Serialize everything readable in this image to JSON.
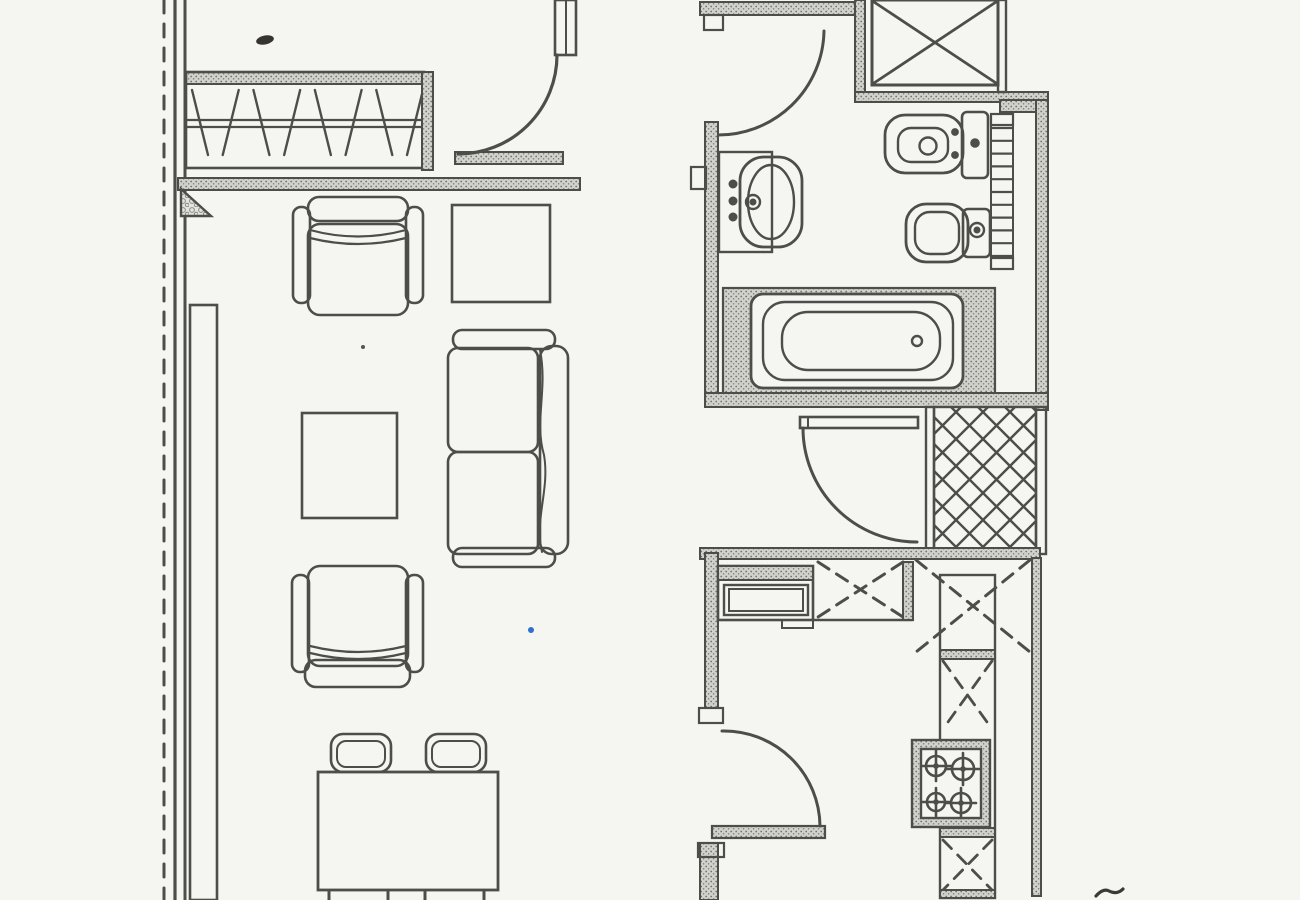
{
  "document": {
    "kind": "scanned-floor-plan",
    "title": "apartment-floor-plan"
  },
  "canvas": {
    "w": 1300,
    "h": 900,
    "paper": "#f5f5f2",
    "ink": "#4d4d49",
    "accent_blue": "#2f6fce"
  },
  "elements": [
    {
      "name": "site-boundary-dashed-line",
      "kind": "line",
      "x1": 164,
      "y1": 0,
      "x2": 164,
      "y2": 900,
      "dash": "13 11",
      "sw": 3
    },
    {
      "name": "left-wall-outer-line",
      "kind": "line",
      "x1": 175,
      "y1": 0,
      "x2": 175,
      "y2": 900,
      "sw": 3.2
    },
    {
      "name": "left-wall-inner-line",
      "kind": "line",
      "x1": 185,
      "y1": 0,
      "x2": 185,
      "y2": 900,
      "sw": 3
    },
    {
      "name": "wardrobe-top-wall",
      "kind": "rect",
      "x": 185,
      "y": 72,
      "w": 240,
      "h": 12,
      "fill": "stipple",
      "sw": 2
    },
    {
      "name": "wardrobe-outline",
      "kind": "rect",
      "x": 186,
      "y": 72,
      "w": 238,
      "h": 96,
      "sw": 2.6
    },
    {
      "name": "wardrobe-rail-upper",
      "kind": "line",
      "x1": 187,
      "y1": 120,
      "x2": 423,
      "y2": 120,
      "sw": 2.2
    },
    {
      "name": "wardrobe-rail-lower",
      "kind": "line",
      "x1": 187,
      "y1": 127,
      "x2": 423,
      "y2": 127,
      "sw": 2.2
    },
    {
      "name": "wardrobe-hangers",
      "kind": "zigzag",
      "x": 192,
      "y": 90,
      "w": 215,
      "h": 65,
      "n": 8,
      "slant": 16,
      "sw": 2.4
    },
    {
      "name": "wardrobe-partition-wall",
      "kind": "rect",
      "x": 422,
      "y": 72,
      "w": 11,
      "h": 98,
      "fill": "stipple",
      "sw": 2
    },
    {
      "name": "entry-threshold-wall",
      "kind": "rect",
      "x": 455,
      "y": 152,
      "w": 108,
      "h": 12,
      "fill": "stipple",
      "sw": 2
    },
    {
      "name": "living-divider-wall",
      "kind": "rect",
      "x": 178,
      "y": 178,
      "w": 402,
      "h": 12,
      "fill": "stipple",
      "sw": 2
    },
    {
      "name": "corner-buttress-triangle",
      "kind": "poly",
      "points": "181,189 181,216 211,216",
      "fill": "pebble",
      "sw": 2.4
    },
    {
      "name": "entry-door-jamb",
      "kind": "rect",
      "x": 555,
      "y": 0,
      "w": 21,
      "h": 55,
      "fill": "paper",
      "sw": 2.6
    },
    {
      "name": "entry-door-jamb-inner-line",
      "kind": "line",
      "x1": 566,
      "y1": 0,
      "x2": 566,
      "y2": 55,
      "sw": 2
    },
    {
      "name": "entry-door-arc",
      "kind": "path",
      "d": "M 557,55 A 99,99 0 0 1 458,154",
      "sw": 3.2
    },
    {
      "name": "bathroom-top-wall",
      "kind": "rect",
      "x": 700,
      "y": 2,
      "w": 157,
      "h": 13,
      "fill": "stipple",
      "sw": 2
    },
    {
      "name": "bathroom-door-jamb",
      "kind": "rect",
      "x": 704,
      "y": 15,
      "w": 19,
      "h": 15,
      "sw": 2.2
    },
    {
      "name": "bathroom-door-arc",
      "kind": "path",
      "d": "M 824,31 A 106,106 0 0 1 716,135",
      "sw": 3
    },
    {
      "name": "bathroom-left-wall",
      "kind": "rect",
      "x": 705,
      "y": 122,
      "w": 13,
      "h": 285,
      "fill": "stipple",
      "sw": 2
    },
    {
      "name": "wall-niche-box",
      "kind": "rect",
      "x": 691,
      "y": 167,
      "w": 15,
      "h": 22,
      "sw": 2.2
    },
    {
      "name": "duct-left-wall",
      "kind": "rect",
      "x": 855,
      "y": 0,
      "w": 10,
      "h": 95,
      "fill": "stipple",
      "sw": 2
    },
    {
      "name": "duct-box",
      "kind": "rect",
      "x": 872,
      "y": 0,
      "w": 126,
      "h": 85,
      "sw": 3
    },
    {
      "name": "duct-cross-a",
      "kind": "line",
      "x1": 874,
      "y1": 2,
      "x2": 996,
      "y2": 83,
      "sw": 2.8
    },
    {
      "name": "duct-cross-b",
      "kind": "line",
      "x1": 996,
      "y1": 2,
      "x2": 874,
      "y2": 83,
      "sw": 2.8
    },
    {
      "name": "duct-bottom-wall",
      "kind": "rect",
      "x": 855,
      "y": 92,
      "w": 193,
      "h": 10,
      "fill": "stipple",
      "sw": 2
    },
    {
      "name": "duct-right-wall",
      "kind": "rect",
      "x": 998,
      "y": 0,
      "w": 8,
      "h": 92,
      "sw": 2.4
    },
    {
      "name": "bathroom-right-jog-wall",
      "kind": "rect",
      "x": 1000,
      "y": 100,
      "w": 38,
      "h": 12,
      "fill": "stipple",
      "sw": 2
    },
    {
      "name": "bathroom-right-wall",
      "kind": "rect",
      "x": 1036,
      "y": 100,
      "w": 12,
      "h": 310,
      "fill": "stipple",
      "sw": 2
    },
    {
      "name": "sink-counter",
      "kind": "rect",
      "x": 719,
      "y": 152,
      "w": 53,
      "h": 100,
      "sw": 2.4
    },
    {
      "name": "sink-basin-outer",
      "kind": "rect",
      "x": 740,
      "y": 157,
      "w": 62,
      "h": 90,
      "rx": 24,
      "sw": 2.8
    },
    {
      "name": "sink-basin-inner",
      "kind": "ellipse",
      "cx": 771,
      "cy": 202,
      "rx": 23,
      "ry": 37,
      "sw": 2.4
    },
    {
      "name": "sink-faucet",
      "kind": "circle",
      "cx": 753,
      "cy": 202,
      "r": 7,
      "sw": 2.4
    },
    {
      "name": "sink-faucet-dot",
      "kind": "circle",
      "cx": 753,
      "cy": 202,
      "r": 2.2,
      "fill": "ink"
    },
    {
      "name": "sink-tap-knobs",
      "kind": "dots",
      "pts": [
        [
          733,
          184,
          3.2
        ],
        [
          733,
          201,
          3.2
        ],
        [
          733,
          217,
          3.2
        ]
      ]
    },
    {
      "name": "toilet-bowl",
      "kind": "rect",
      "x": 885,
      "y": 115,
      "w": 78,
      "h": 58,
      "rx": 20,
      "sw": 2.8
    },
    {
      "name": "toilet-bowl-inner",
      "kind": "rect",
      "x": 898,
      "y": 128,
      "w": 50,
      "h": 34,
      "rx": 13,
      "sw": 2.4
    },
    {
      "name": "toilet-drain",
      "kind": "circle",
      "cx": 928,
      "cy": 146,
      "r": 8.5,
      "sw": 2.4
    },
    {
      "name": "toilet-hinge-dots",
      "kind": "dots",
      "pts": [
        [
          955,
          132,
          2.6
        ],
        [
          955,
          155,
          2.6
        ]
      ]
    },
    {
      "name": "toilet-tank",
      "kind": "rect",
      "x": 962,
      "y": 112,
      "w": 26,
      "h": 66,
      "rx": 5,
      "sw": 2.6
    },
    {
      "name": "toilet-flush-button",
      "kind": "circle",
      "cx": 975,
      "cy": 143,
      "r": 3.5,
      "fill": "ink"
    },
    {
      "name": "towel-radiator-frame",
      "kind": "rect",
      "x": 991,
      "y": 114,
      "w": 22,
      "h": 155,
      "sw": 2
    },
    {
      "name": "towel-radiator-cap-top",
      "kind": "rect",
      "x": 991,
      "y": 114,
      "w": 22,
      "h": 11,
      "sw": 2.2
    },
    {
      "name": "towel-radiator-rungs",
      "kind": "rungs",
      "x": 991,
      "y": 128,
      "w": 22,
      "h": 128,
      "n": 11,
      "sw": 2.2
    },
    {
      "name": "towel-radiator-cap-bottom",
      "kind": "rect",
      "x": 991,
      "y": 258,
      "w": 22,
      "h": 11,
      "sw": 2.2
    },
    {
      "name": "bidet-bowl",
      "kind": "rect",
      "x": 906,
      "y": 204,
      "w": 62,
      "h": 58,
      "rx": 20,
      "sw": 2.8
    },
    {
      "name": "bidet-bowl-inner",
      "kind": "rect",
      "x": 915,
      "y": 212,
      "w": 44,
      "h": 42,
      "rx": 15,
      "sw": 2.4
    },
    {
      "name": "bidet-cistern",
      "kind": "rect",
      "x": 963,
      "y": 209,
      "w": 27,
      "h": 48,
      "rx": 5,
      "sw": 2.6
    },
    {
      "name": "bidet-faucet",
      "kind": "circle",
      "cx": 977,
      "cy": 230,
      "r": 7,
      "sw": 2.4
    },
    {
      "name": "bidet-faucet-dot",
      "kind": "circle",
      "cx": 977,
      "cy": 230,
      "r": 2.2,
      "fill": "ink"
    },
    {
      "name": "tub-surround",
      "kind": "rect",
      "x": 723,
      "y": 288,
      "w": 272,
      "h": 106,
      "fill": "stipple",
      "sw": 2.2
    },
    {
      "name": "tub-outer",
      "kind": "rect",
      "x": 751,
      "y": 294,
      "w": 212,
      "h": 94,
      "rx": 12,
      "fill": "paper",
      "sw": 2.8
    },
    {
      "name": "tub-middle",
      "kind": "rect",
      "x": 763,
      "y": 302,
      "w": 190,
      "h": 78,
      "rx": 22,
      "sw": 2.4
    },
    {
      "name": "tub-basin",
      "kind": "rect",
      "x": 782,
      "y": 312,
      "w": 158,
      "h": 58,
      "rx": 26,
      "sw": 2.4
    },
    {
      "name": "tub-drain",
      "kind": "circle",
      "cx": 917,
      "cy": 341,
      "r": 5,
      "sw": 2.4
    },
    {
      "name": "bathroom-bottom-wall",
      "kind": "rect",
      "x": 705,
      "y": 393,
      "w": 343,
      "h": 14,
      "fill": "stipple",
      "sw": 2
    },
    {
      "name": "hall-door-leaf",
      "kind": "rect",
      "x": 800,
      "y": 417,
      "w": 118,
      "h": 11,
      "fill": "paper",
      "sw": 2.6
    },
    {
      "name": "hall-door-leaf-cap",
      "kind": "line",
      "x1": 808,
      "y1": 417,
      "x2": 808,
      "y2": 428,
      "sw": 2
    },
    {
      "name": "hall-door-arc",
      "kind": "path",
      "d": "M 803,428 A 114,114 0 0 0 917,542",
      "sw": 3
    },
    {
      "name": "shaft-left-wall",
      "kind": "rect",
      "x": 926,
      "y": 407,
      "w": 8,
      "h": 147,
      "sw": 2.4
    },
    {
      "name": "shaft-lattice",
      "kind": "lattice",
      "x": 934,
      "y": 407,
      "w": 102,
      "h": 145,
      "step": 27,
      "sw": 2.4
    },
    {
      "name": "shaft-outline",
      "kind": "rect",
      "x": 934,
      "y": 407,
      "w": 102,
      "h": 145,
      "sw": 2.4
    },
    {
      "name": "shaft-right-wall",
      "kind": "rect",
      "x": 1036,
      "y": 407,
      "w": 10,
      "h": 147,
      "sw": 2.4
    },
    {
      "name": "kitchen-top-wall",
      "kind": "rect",
      "x": 700,
      "y": 548,
      "w": 340,
      "h": 11,
      "fill": "stipple",
      "sw": 2
    },
    {
      "name": "kitchen-left-wall",
      "kind": "rect",
      "x": 705,
      "y": 553,
      "w": 13,
      "h": 155,
      "fill": "stipple",
      "sw": 2
    },
    {
      "name": "kitchen-door-jamb-upper",
      "kind": "rect",
      "x": 699,
      "y": 708,
      "w": 24,
      "h": 15,
      "sw": 2.2
    },
    {
      "name": "kitchen-door-leaf",
      "kind": "rect",
      "x": 712,
      "y": 826,
      "w": 113,
      "h": 12,
      "fill": "stipple",
      "sw": 2.2
    },
    {
      "name": "kitchen-door-arc",
      "kind": "path",
      "d": "M 722,731 A 96,96 0 0 1 820,826",
      "sw": 3
    },
    {
      "name": "kitchen-left-wall-lower",
      "kind": "rect",
      "x": 700,
      "y": 843,
      "w": 18,
      "h": 57,
      "fill": "stipple",
      "sw": 2
    },
    {
      "name": "kitchen-door-jamb-lower",
      "kind": "rect",
      "x": 698,
      "y": 843,
      "w": 26,
      "h": 14,
      "sw": 2.2
    },
    {
      "name": "kitchen-sink-unit",
      "kind": "rect",
      "x": 718,
      "y": 566,
      "w": 95,
      "h": 54,
      "sw": 2.6
    },
    {
      "name": "kitchen-sink-top-band",
      "kind": "rect",
      "x": 718,
      "y": 566,
      "w": 95,
      "h": 14,
      "fill": "stipple",
      "sw": 2
    },
    {
      "name": "kitchen-sink-inner",
      "kind": "rect",
      "x": 724,
      "y": 585,
      "w": 84,
      "h": 30,
      "sw": 2.4
    },
    {
      "name": "kitchen-sink-inner2",
      "kind": "rect",
      "x": 729,
      "y": 589,
      "w": 74,
      "h": 22,
      "sw": 2
    },
    {
      "name": "kitchen-drawer-front",
      "kind": "rect",
      "x": 782,
      "y": 620,
      "w": 31,
      "h": 8,
      "sw": 2
    },
    {
      "name": "kitchen-counter-front-edge",
      "kind": "line",
      "x1": 813,
      "y1": 620,
      "x2": 913,
      "y2": 620,
      "sw": 2.4
    },
    {
      "name": "upper-cabinet-x1",
      "kind": "xcross",
      "x": 818,
      "y": 562,
      "w": 85,
      "h": 55,
      "dash": "13 9",
      "sw": 3
    },
    {
      "name": "counter-divider",
      "kind": "rect",
      "x": 903,
      "y": 562,
      "w": 10,
      "h": 58,
      "fill": "stipple",
      "sw": 2
    },
    {
      "name": "upper-cabinet-x2-corner",
      "kind": "xcross",
      "x": 916,
      "y": 560,
      "w": 114,
      "h": 92,
      "dash": "13 9",
      "sw": 3
    },
    {
      "name": "side-counter-outline",
      "kind": "rect",
      "x": 940,
      "y": 575,
      "w": 55,
      "h": 323,
      "sw": 2.4
    },
    {
      "name": "side-counter-divider1",
      "kind": "rect",
      "x": 940,
      "y": 650,
      "w": 55,
      "h": 9,
      "fill": "stipple",
      "sw": 2
    },
    {
      "name": "side-cabinet-x1",
      "kind": "xcross",
      "x": 943,
      "y": 661,
      "w": 49,
      "h": 68,
      "dash": "12 9",
      "sw": 2.8
    },
    {
      "name": "stove",
      "kind": "rect",
      "x": 912,
      "y": 740,
      "w": 78,
      "h": 87,
      "fill": "stipple",
      "sw": 2.4
    },
    {
      "name": "stove-inner",
      "kind": "rect",
      "x": 921,
      "y": 749,
      "w": 60,
      "h": 69,
      "fill": "paper",
      "sw": 2.4
    },
    {
      "name": "stove-burner-1",
      "kind": "burner",
      "cx": 936,
      "cy": 766,
      "r": 10
    },
    {
      "name": "stove-burner-2",
      "kind": "burner",
      "cx": 963,
      "cy": 769,
      "r": 11
    },
    {
      "name": "stove-burner-3",
      "kind": "burner",
      "cx": 936,
      "cy": 802,
      "r": 9
    },
    {
      "name": "stove-burner-4",
      "kind": "burner",
      "cx": 961,
      "cy": 803,
      "r": 10
    },
    {
      "name": "side-counter-divider2",
      "kind": "rect",
      "x": 940,
      "y": 828,
      "w": 55,
      "h": 9,
      "fill": "stipple",
      "sw": 2
    },
    {
      "name": "side-cabinet-x2",
      "kind": "xcross",
      "x": 943,
      "y": 840,
      "w": 49,
      "h": 50,
      "dash": "12 9",
      "sw": 2.8
    },
    {
      "name": "side-counter-bottom",
      "kind": "rect",
      "x": 940,
      "y": 890,
      "w": 55,
      "h": 8,
      "fill": "stipple",
      "sw": 2
    },
    {
      "name": "kitchen-right-wall",
      "kind": "rect",
      "x": 1032,
      "y": 558,
      "w": 9,
      "h": 338,
      "fill": "stipple",
      "sw": 2
    },
    {
      "name": "sideboard",
      "kind": "rect",
      "x": 190,
      "y": 305,
      "w": 27,
      "h": 595,
      "sw": 2.6
    },
    {
      "name": "side-table",
      "kind": "rect",
      "x": 452,
      "y": 205,
      "w": 98,
      "h": 97,
      "sw": 2.6
    },
    {
      "name": "armchair1-back",
      "kind": "rect",
      "x": 308,
      "y": 197,
      "w": 100,
      "h": 24,
      "rx": 11,
      "sw": 2.6
    },
    {
      "name": "armchair1-arm-left",
      "kind": "rect",
      "x": 293,
      "y": 207,
      "w": 17,
      "h": 96,
      "rx": 8,
      "sw": 2.6
    },
    {
      "name": "armchair1-arm-right",
      "kind": "rect",
      "x": 406,
      "y": 207,
      "w": 17,
      "h": 96,
      "rx": 8,
      "sw": 2.6
    },
    {
      "name": "armchair1-seat",
      "kind": "rect",
      "x": 308,
      "y": 224,
      "w": 100,
      "h": 91,
      "rx": 12,
      "sw": 2.6
    },
    {
      "name": "armchair1-cushion-line1",
      "kind": "path",
      "d": "M 310,230 Q 358,243 406,230",
      "sw": 2.2
    },
    {
      "name": "armchair1-cushion-line2",
      "kind": "path",
      "d": "M 310,238 Q 358,250 406,238",
      "sw": 2.2
    },
    {
      "name": "coffee-table",
      "kind": "rect",
      "x": 302,
      "y": 413,
      "w": 95,
      "h": 105,
      "sw": 2.6
    },
    {
      "name": "sofa-arm-top",
      "kind": "rect",
      "x": 453,
      "y": 330,
      "w": 102,
      "h": 19,
      "rx": 9,
      "sw": 2.6
    },
    {
      "name": "sofa-arm-bottom",
      "kind": "rect",
      "x": 453,
      "y": 548,
      "w": 102,
      "h": 19,
      "rx": 9,
      "sw": 2.6
    },
    {
      "name": "sofa-back",
      "kind": "rect",
      "x": 540,
      "y": 346,
      "w": 28,
      "h": 208,
      "rx": 12,
      "sw": 2.6
    },
    {
      "name": "sofa-seat1",
      "kind": "rect",
      "x": 448,
      "y": 348,
      "w": 90,
      "h": 104,
      "rx": 10,
      "sw": 2.6
    },
    {
      "name": "sofa-seat2",
      "kind": "rect",
      "x": 448,
      "y": 452,
      "w": 90,
      "h": 102,
      "rx": 10,
      "sw": 2.6
    },
    {
      "name": "sofa-wavy-line",
      "kind": "path",
      "d": "M 540,350 C 548,390 534,420 544,455 C 550,490 534,520 542,552",
      "sw": 2
    },
    {
      "name": "armchair2-seat",
      "kind": "rect",
      "x": 308,
      "y": 566,
      "w": 100,
      "h": 100,
      "rx": 12,
      "sw": 2.6
    },
    {
      "name": "armchair2-arm-left",
      "kind": "rect",
      "x": 292,
      "y": 575,
      "w": 17,
      "h": 97,
      "rx": 8,
      "sw": 2.6
    },
    {
      "name": "armchair2-arm-right",
      "kind": "rect",
      "x": 406,
      "y": 575,
      "w": 17,
      "h": 97,
      "rx": 8,
      "sw": 2.6
    },
    {
      "name": "armchair2-back",
      "kind": "rect",
      "x": 305,
      "y": 660,
      "w": 105,
      "h": 27,
      "rx": 11,
      "sw": 2.6
    },
    {
      "name": "armchair2-cushion-line1",
      "kind": "path",
      "d": "M 310,646 Q 358,658 406,646",
      "sw": 2.2
    },
    {
      "name": "armchair2-cushion-line2",
      "kind": "path",
      "d": "M 310,653 Q 358,665 406,653",
      "sw": 2.2
    },
    {
      "name": "dining-chair-a",
      "kind": "rect",
      "x": 331,
      "y": 734,
      "w": 60,
      "h": 38,
      "rx": 12,
      "sw": 2.6
    },
    {
      "name": "dining-chair-a-inner",
      "kind": "rect",
      "x": 337,
      "y": 741,
      "w": 48,
      "h": 26,
      "rx": 9,
      "sw": 2
    },
    {
      "name": "dining-chair-b",
      "kind": "rect",
      "x": 426,
      "y": 734,
      "w": 60,
      "h": 38,
      "rx": 12,
      "sw": 2.6
    },
    {
      "name": "dining-chair-b-inner",
      "kind": "rect",
      "x": 432,
      "y": 741,
      "w": 48,
      "h": 26,
      "rx": 9,
      "sw": 2
    },
    {
      "name": "dining-table",
      "kind": "rect",
      "x": 318,
      "y": 772,
      "w": 180,
      "h": 118,
      "fill": "paper",
      "sw": 2.8
    },
    {
      "name": "dining-chair-c-stub1",
      "kind": "line",
      "x1": 329,
      "y1": 891,
      "x2": 329,
      "y2": 900,
      "sw": 3
    },
    {
      "name": "dining-chair-c-stub2",
      "kind": "line",
      "x1": 388,
      "y1": 891,
      "x2": 388,
      "y2": 900,
      "sw": 3
    },
    {
      "name": "dining-chair-d-stub1",
      "kind": "line",
      "x1": 425,
      "y1": 891,
      "x2": 425,
      "y2": 900,
      "sw": 3
    },
    {
      "name": "dining-chair-d-stub2",
      "kind": "line",
      "x1": 484,
      "y1": 891,
      "x2": 484,
      "y2": 900,
      "sw": 3
    },
    {
      "name": "ink-blot-mark",
      "kind": "ellipse",
      "cx": 265,
      "cy": 40,
      "rx": 9,
      "ry": 4.5,
      "fill": "#35342f",
      "sw": 0,
      "transform": "rotate(-12 265 40)"
    },
    {
      "name": "blue-dot-mark",
      "kind": "circle",
      "cx": 531,
      "cy": 630,
      "r": 3,
      "fill": "#2f6fce",
      "sw": 0
    },
    {
      "name": "small-speck-mark",
      "kind": "circle",
      "cx": 363,
      "cy": 347,
      "r": 2,
      "fill": "#55544f",
      "sw": 0
    },
    {
      "name": "pen-checkmark",
      "kind": "path",
      "d": "M 1096,896 q 7,-8 13,-5 q 8,4 14,-2",
      "sw": 3.2,
      "stroke": "#3a3935"
    }
  ]
}
